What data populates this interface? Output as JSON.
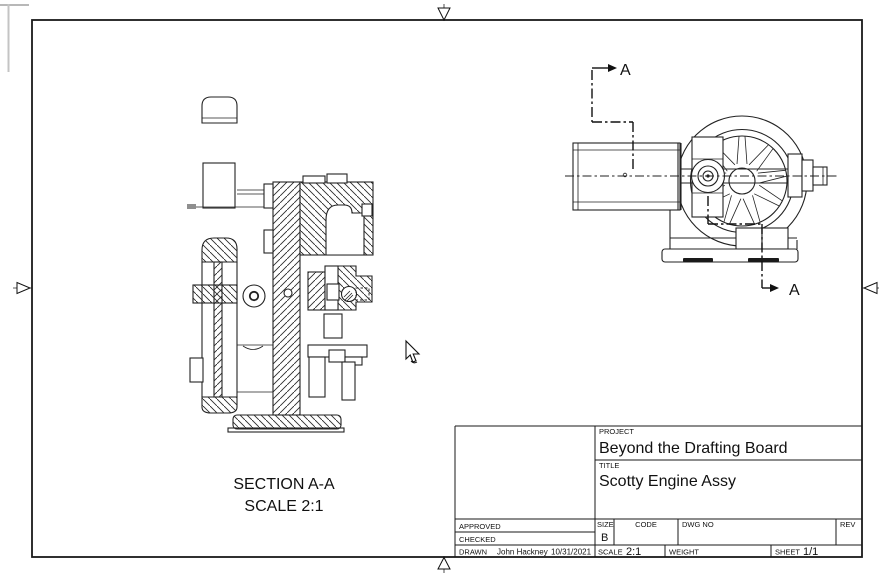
{
  "colors": {
    "line": "#222222",
    "paper_edge": "#b8b8b8",
    "background": "#ffffff"
  },
  "sheet": {
    "section_label_line1": "SECTION A-A",
    "section_label_line2": "SCALE 2:1",
    "cut_arrow_top_label": "A",
    "cut_arrow_bottom_label": "A"
  },
  "title_block": {
    "project_label": "PROJECT",
    "project_value": "Beyond the Drafting Board",
    "title_label": "TITLE",
    "title_value": "Scotty Engine Assy",
    "approved_label": "APPROVED",
    "checked_label": "CHECKED",
    "drawn_label": "DRAWN",
    "drawn_by": "John Hackney",
    "drawn_date": "10/31/2021",
    "size_label": "SIZE",
    "size_value": "B",
    "code_label": "CODE",
    "dwg_no_label": "DWG NO",
    "rev_label": "REV",
    "scale_label": "SCALE",
    "scale_value": "2:1",
    "weight_label": "WEIGHT",
    "sheet_label": "SHEET",
    "sheet_value": "1/1"
  }
}
